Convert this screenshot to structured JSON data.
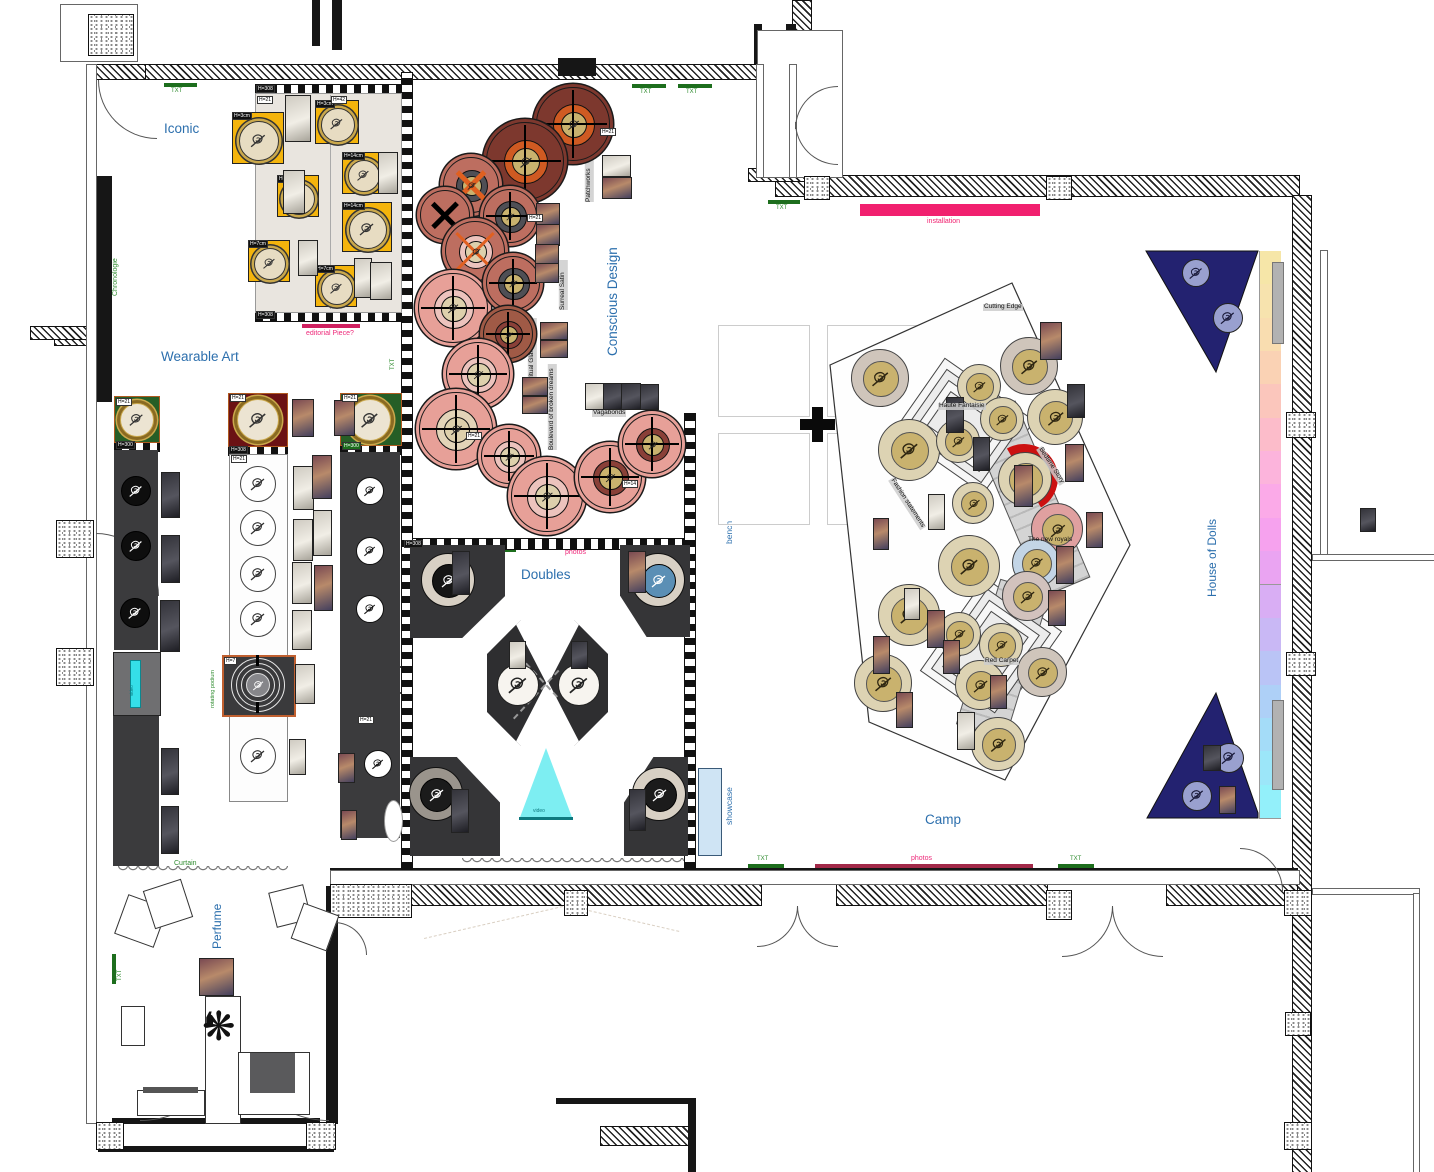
{
  "document": {
    "type": "exhibition floor plan"
  },
  "sections": {
    "iconic": "Iconic",
    "wearable_art": "Wearable Art",
    "conscious_design": "Conscious Design",
    "doubles": "Doubles",
    "camp": "Camp",
    "house_of_dolls": "House of Dolls",
    "perfume": "Perfume",
    "bench": "bench",
    "showcase": "showcase"
  },
  "markers": {
    "txt": "TXT",
    "chronologie": "Chronologie",
    "curtain": "Curtain",
    "rotating_podium": "rotating podium",
    "video": "video"
  },
  "annotations": {
    "editorial_piece": "editorial Piece?",
    "installation": "installation",
    "photos": "photos"
  },
  "iconic_area": {
    "year": "2018",
    "collection": "Immaculate Collection"
  },
  "zones": {
    "conscious": [
      "Patchworks",
      "Surreal Satin",
      "Spiritual Glamour",
      "Boulevard of broken dreams",
      "Vagabonds"
    ],
    "camp": [
      "Cutting Edge",
      "Haute Fantaisie",
      "Bedtime Story",
      "The new royals",
      "Red Carpet",
      "Fashion statements"
    ]
  },
  "height_tags": {
    "h21": "H=21",
    "h42": "H=42",
    "h308": "H=308",
    "h300": "H=300",
    "h14": "H=14",
    "h7": "H=7",
    "h3cm": "H=3cm",
    "h14cm": "H=14cm",
    "h7cm": "H=7cm"
  },
  "icons": {
    "mannequin": "mannequin-top-view-icon",
    "doll": "doll-icon",
    "star": "starburst-icon",
    "crosshair": "crosshair-icon",
    "x_mark": "x-mark-icon",
    "plus": "plus-icon"
  },
  "colors": {
    "label_blue": "#2c6fad",
    "marker_green": "#2e8b2e",
    "installation_pink": "#f1206f",
    "photos_bar": "#a22848",
    "editorial_bar": "#cf2060",
    "platform_yellow": "#f4b40c",
    "platform_green": "#265e26",
    "platform_maroon": "#6b1214",
    "circle_maroon": "#7d382e",
    "circle_salmon": "#bd6e60",
    "circle_pink": "#e7a098",
    "navy": "#232270",
    "lavender": "#99a0cf",
    "camp_ring_beige": "#ddd3b3",
    "camp_gold": "#c9b26e",
    "video_cyan": "#7deef2",
    "dark_platform": "#3a3a3c",
    "showcase_blue": "#cfe4f4",
    "red_arc": "#cc1111",
    "orange_x": "#e06020"
  }
}
